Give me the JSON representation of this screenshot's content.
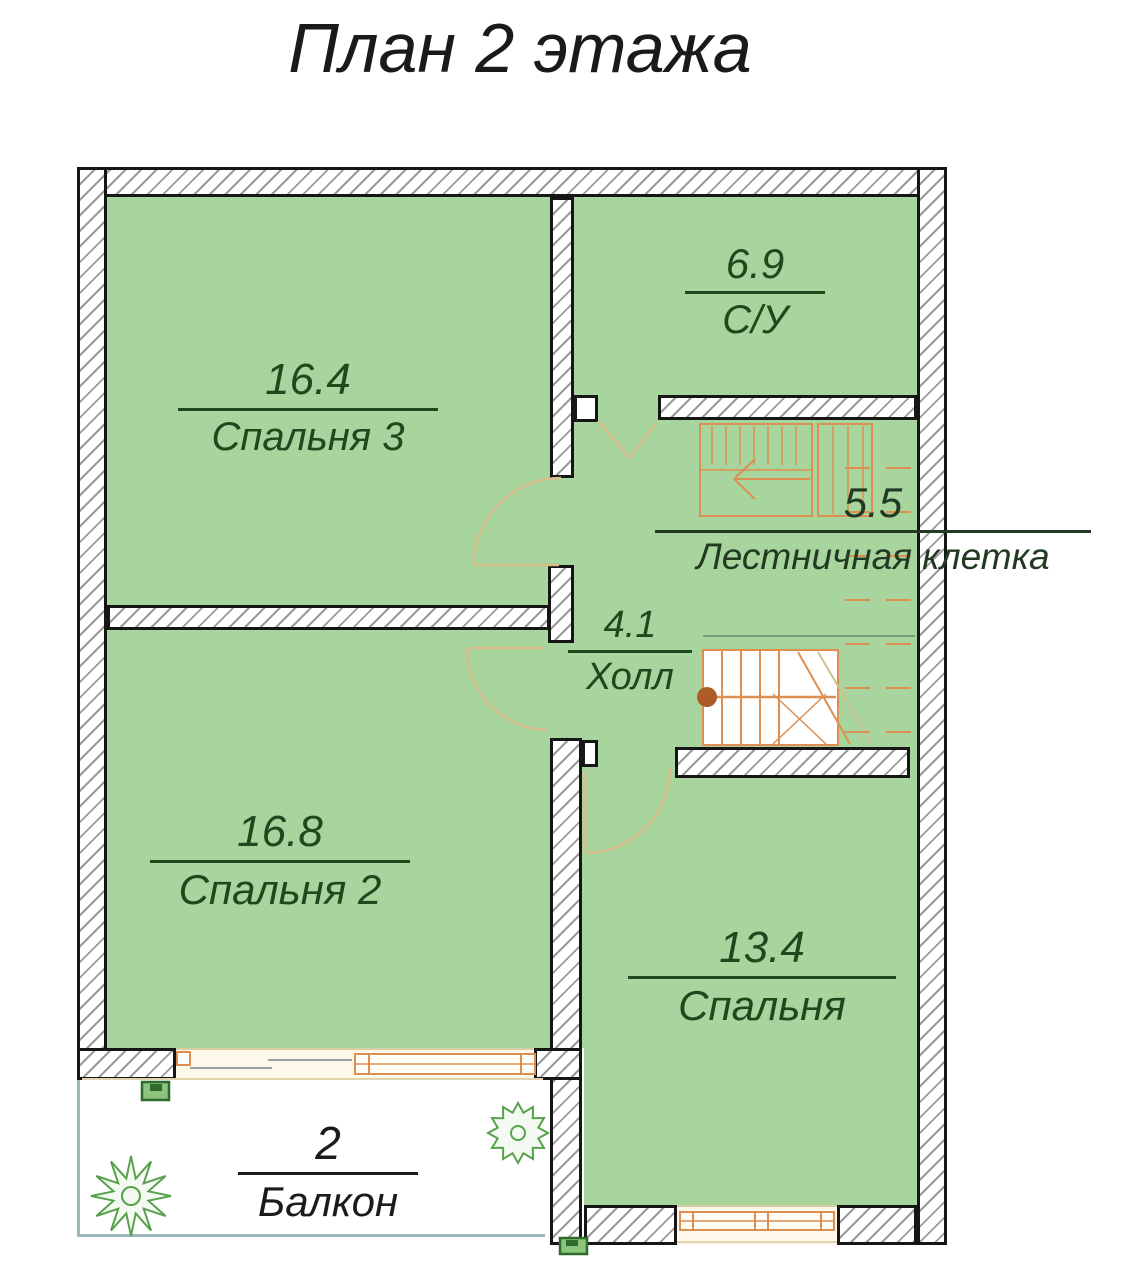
{
  "title": "План 2 этажа",
  "rooms": [
    {
      "id": "bedroom3",
      "area": "16.4",
      "name": "Спальня 3"
    },
    {
      "id": "bathroom",
      "area": "6.9",
      "name": "С/У"
    },
    {
      "id": "staircase",
      "area": "5.5",
      "name": "Лестничная клетка"
    },
    {
      "id": "hall",
      "area": "4.1",
      "name": "Холл"
    },
    {
      "id": "bedroom2",
      "area": "16.8",
      "name": "Спальня 2"
    },
    {
      "id": "bedroom",
      "area": "13.4",
      "name": "Спальня"
    },
    {
      "id": "balcony",
      "area": "2",
      "name": "Балкон"
    }
  ],
  "colors": {
    "room_fill": "#a8d49e",
    "wall_outline": "#161616",
    "wall_hatch_line": "#9a9a9a",
    "label_text_green": "#1d4a1d",
    "balcony_text": "#1b1b1b",
    "joinery_orange": "#dd8f52",
    "door_arc_tan": "#d6bd8c",
    "newel_brown": "#ad5b28",
    "plant_green": "#57a24c",
    "marker_green": "#8cc47e",
    "balcony_border_teal": "#9db8b8",
    "window_band_cream": "#fdf8ea"
  }
}
